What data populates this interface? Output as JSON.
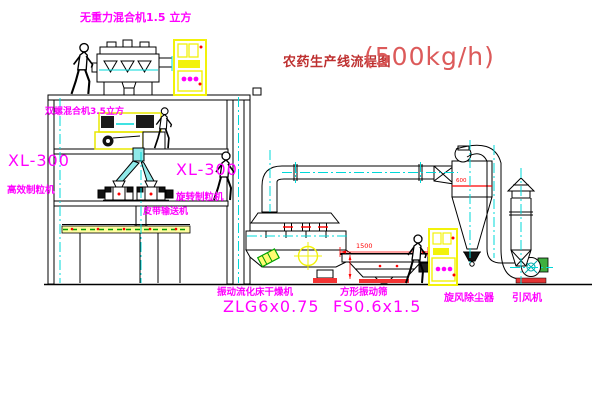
{
  "title": {
    "text": "农药生产线流程图",
    "capacity": "(500kg/h)"
  },
  "labels": {
    "top_mixer": "无重力混合机1.5 立方",
    "floor2_mixer": "双螺混合机3.5立方",
    "granulator_left_model": "XL-300",
    "granulator_left_name": "高效制粒机",
    "granulator_mid_model": "XL-300",
    "granulator_mid_name": "旋转制粒机",
    "belt_conveyor": "皮带输送机",
    "dryer_name": "振动流化床干燥机",
    "dryer_model": "ZLG6x0.75",
    "sieve_name": "方形振动筛",
    "sieve_model": "FS0.6x1.5",
    "cyclone_name": "旋风除尘器",
    "fan_name": "引风机"
  },
  "dimensions": {
    "sieve_width": "1500",
    "cyclone_mark": "600"
  },
  "colors": {
    "background": "#FFFFFF",
    "label_magenta": "#FF00FF",
    "title_red": "#BE3030",
    "capacity_red": "#DC5A5A",
    "dimension_red": "#FF0000",
    "centerline_cyan": "#00D8D8",
    "cabinet_yellow": "#F2F20A",
    "pipe_cyan_fill": "#8FE9E9",
    "line_black": "#000000"
  },
  "icons": {
    "worker_figure": "human-silhouette",
    "control_cabinet": "yellow-electrical-cabinet",
    "target_mark": "yellow-crosshair-circle"
  }
}
